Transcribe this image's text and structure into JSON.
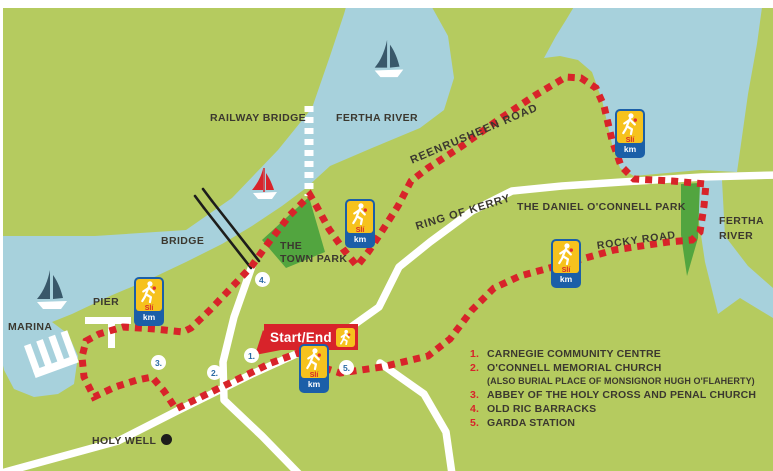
{
  "colors": {
    "land": "#b5cb5f",
    "water": "#a7d1dc",
    "park_green": "#52a53f",
    "route_red": "#d8232a",
    "road_white": "#ffffff",
    "label_dark": "#3b382f",
    "waypoint_blue": "#2a6ba4",
    "sli_blue": "#1b5fa8",
    "sli_yellow": "#f6c21d"
  },
  "map": {
    "labels": {
      "railway_bridge": "RAILWAY BRIDGE",
      "fertha_river_top": "FERTHA RIVER",
      "reenrusheen_road": "REENRUSHEEN ROAD",
      "ring_of_kerry": "RING OF KERRY",
      "daniel_oconnell_park": "THE DANIEL O'CONNELL PARK",
      "fertha_right_line1": "FERTHA",
      "fertha_right_line2": "RIVER",
      "rocky_road": "ROCKY ROAD",
      "bridge": "BRIDGE",
      "town_park_line1": "THE",
      "town_park_line2": "TOWN PARK",
      "pier": "PIER",
      "marina": "MARINA",
      "holy_well": "HOLY WELL",
      "start_end": "Start/End"
    },
    "waypoint_numbers": [
      "1.",
      "2.",
      "3.",
      "4.",
      "5."
    ],
    "sli_marker": {
      "sli": "Slí",
      "km": "km"
    }
  },
  "legend": {
    "items": [
      {
        "number": "1.",
        "label": "CARNEGIE COMMUNITY CENTRE"
      },
      {
        "number": "2.",
        "label": "O'CONNELL MEMORIAL CHURCH",
        "sublabel": "(ALSO BURIAL PLACE OF MONSIGNOR  HUGH O'FLAHERTY)"
      },
      {
        "number": "3.",
        "label": "ABBEY OF THE HOLY CROSS AND PENAL CHURCH"
      },
      {
        "number": "4.",
        "label": "OLD RIC BARRACKS"
      },
      {
        "number": "5.",
        "label": "GARDA STATION"
      }
    ]
  }
}
